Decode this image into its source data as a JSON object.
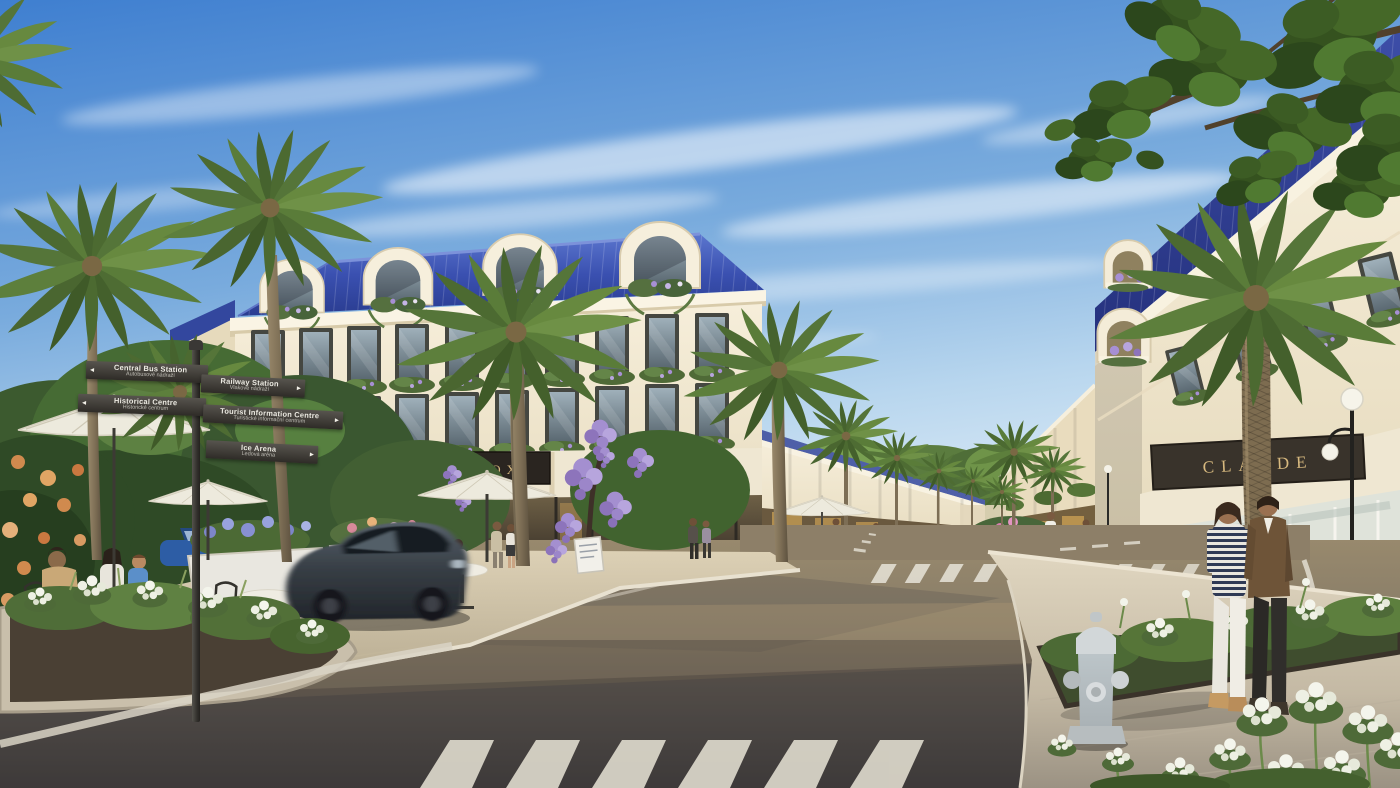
{
  "scene": {
    "description": "Sunny architectural street render with classical shophouses, blue mansard roofs, palm-lined avenue, cafe terrace and pedestrians",
    "storefront_signs": {
      "grace": {
        "label": "GRACE",
        "mark": "✦"
      },
      "fox": {
        "label": "FOX"
      },
      "boreau": {
        "label": "BOREAU"
      },
      "claude": {
        "label": "CLAUDE"
      }
    },
    "wayfinding_signpost": {
      "arrow_left_icon": "◂",
      "arrow_right_icon": "▸",
      "plates": [
        {
          "title": "Central Bus Station",
          "subtitle": "Autobusové nádraží",
          "direction": "left"
        },
        {
          "title": "Historical Centre",
          "subtitle": "Historické centrum",
          "direction": "left"
        },
        {
          "title": "Railway Station",
          "subtitle": "Vlakové nádraží",
          "direction": "right"
        },
        {
          "title": "Tourist Information Centre",
          "subtitle": "Turistické informační centrum",
          "direction": "right"
        },
        {
          "title": "Ice Arena",
          "subtitle": "Ledová aréna",
          "direction": "right"
        }
      ]
    },
    "colors": {
      "sky_top": "#3f7fd0",
      "sky_horizon": "#e8f2fa",
      "roof_blue": "#33479e",
      "facade_cream": "#f2e9d4",
      "sign_plaque_dark": "#2b2520",
      "sign_text_gold": "#d6b67c",
      "boreau_plaque": "#8b8070",
      "road_sunlit": "#9a8b6f",
      "road_shadow": "#4f4c48",
      "palm_green": "#5a7c39",
      "wisteria_purple": "#a78fd4"
    }
  }
}
